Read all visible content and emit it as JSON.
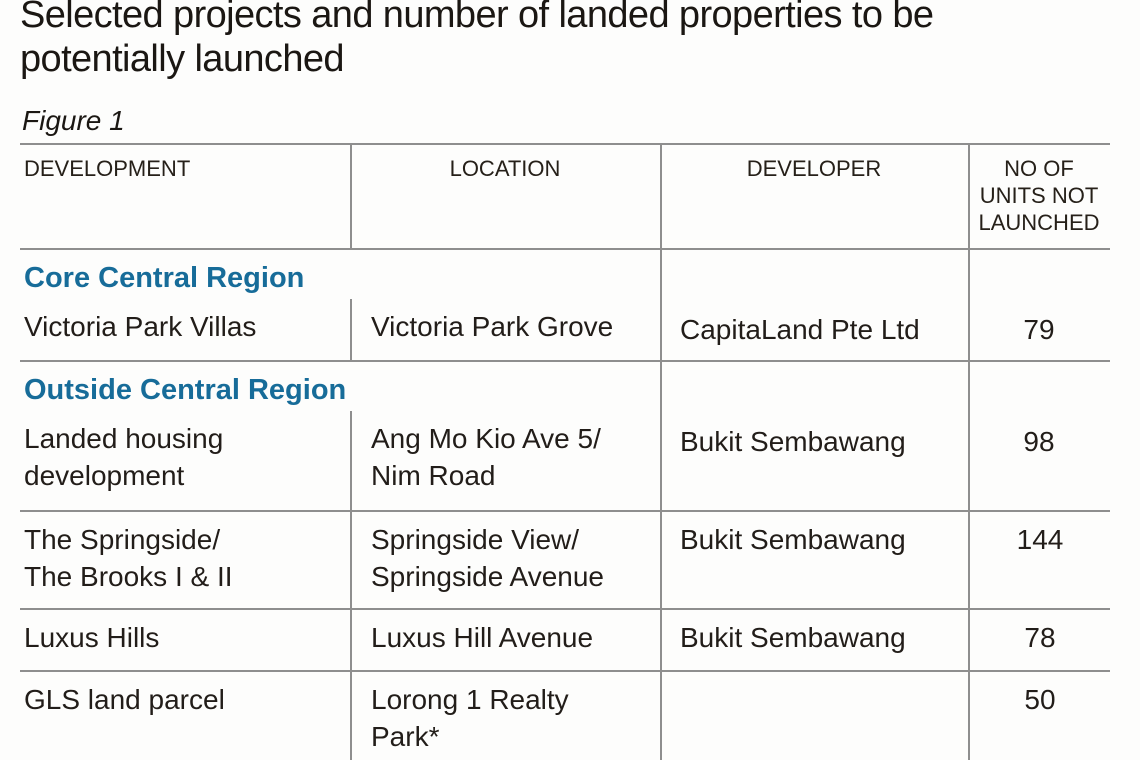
{
  "article": {
    "title": "Selected projects and number of landed properties to be\npotentially launched",
    "figure_label": "Figure 1"
  },
  "colors": {
    "section_heading": "#176c99",
    "grid_line": "#8e8e8e",
    "body_text": "#221d19"
  },
  "table": {
    "columns": [
      "DEVELOPMENT",
      "LOCATION",
      "DEVELOPER",
      "NO OF\nUNITS NOT\nLAUNCHED"
    ],
    "groups": [
      {
        "section": "Core Central Region",
        "rows": [
          {
            "development": "Victoria Park Villas",
            "location": "Victoria Park Grove",
            "developer": "CapitaLand Pte Ltd",
            "units_not_launched": "79"
          }
        ]
      },
      {
        "section": "Outside Central Region",
        "rows": [
          {
            "development": "Landed housing\ndevelopment",
            "location": "Ang Mo Kio Ave 5/\nNim Road",
            "developer": "Bukit Sembawang",
            "units_not_launched": "98"
          },
          {
            "development": "The Springside/\nThe Brooks I & II",
            "location": "Springside View/\nSpringside Avenue",
            "developer": "Bukit Sembawang",
            "units_not_launched": "144"
          },
          {
            "development": "Luxus Hills",
            "location": "Luxus Hill Avenue",
            "developer": "Bukit Sembawang",
            "units_not_launched": "78"
          },
          {
            "development": "GLS land parcel",
            "location": "Lorong 1 Realty\nPark*",
            "developer": "",
            "units_not_launched": "50"
          }
        ]
      }
    ]
  }
}
